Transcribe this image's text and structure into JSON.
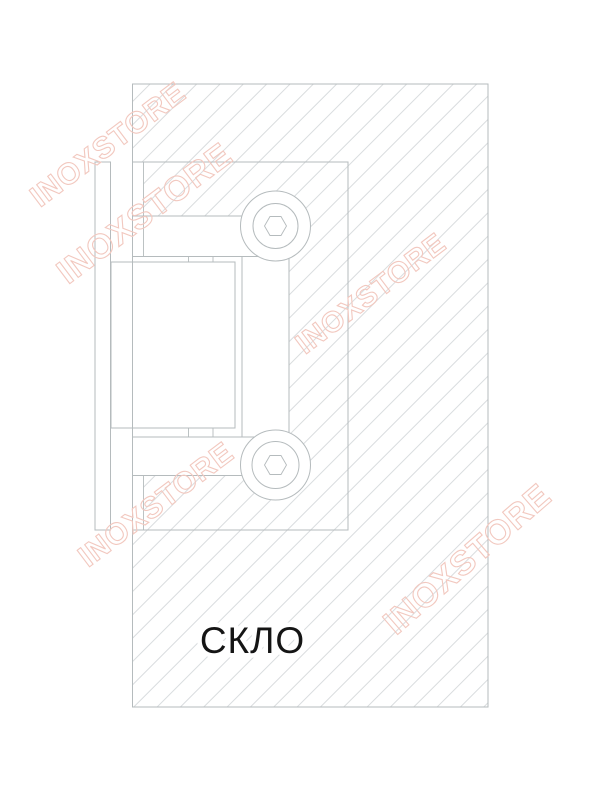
{
  "drawing": {
    "glass_label": "СКЛО",
    "watermark_text": "INOXSTORE",
    "colors": {
      "line": "#b5bbbd",
      "hatch_line": "#cdd1d3",
      "watermark": "#f2c8bf",
      "label_text": "#151515"
    }
  }
}
